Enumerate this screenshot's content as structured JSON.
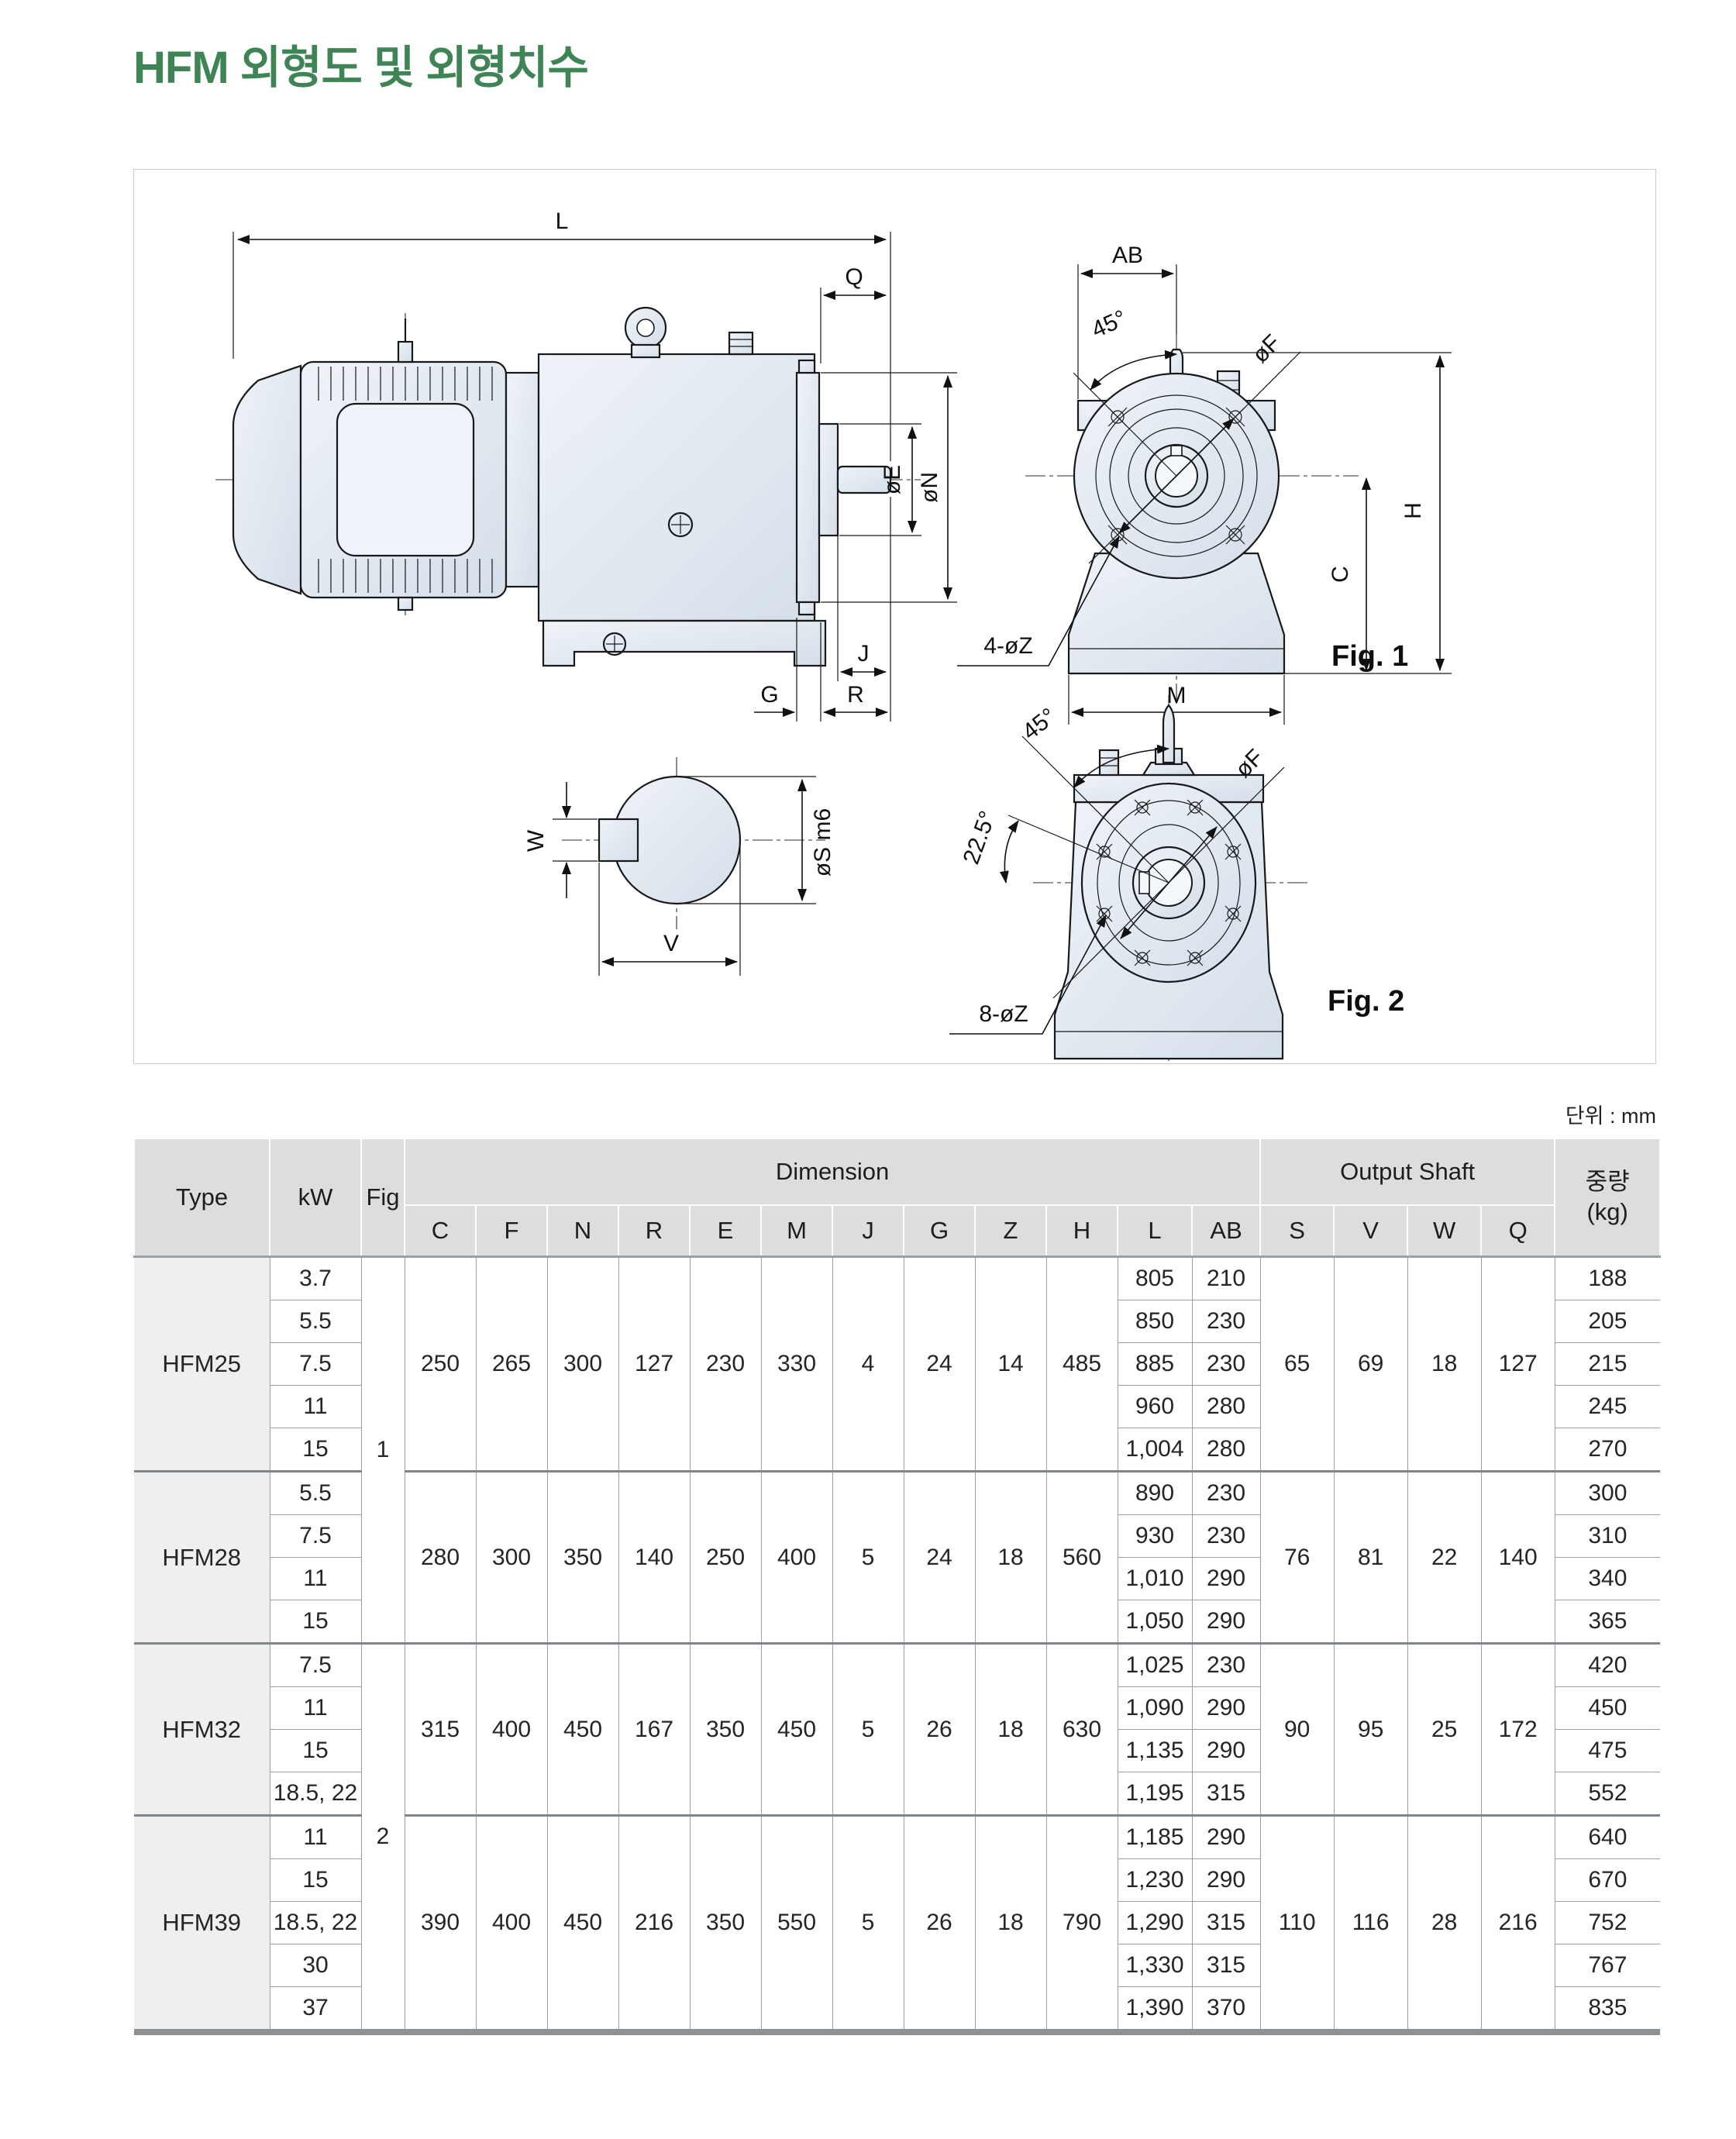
{
  "page": {
    "title": "HFM 외형도 및 외형치수",
    "unit_note": "단위 : mm"
  },
  "drawing": {
    "side_view": {
      "L": "L",
      "Q": "Q",
      "oE": "øE",
      "oN": "øN",
      "J": "J",
      "G": "G",
      "R": "R"
    },
    "fig1": {
      "AB": "AB",
      "angle45": "45°",
      "oF": "øF",
      "H": "H",
      "C": "C",
      "M": "M",
      "bolts": "4-øZ",
      "caption": "Fig. 1"
    },
    "shaft_section": {
      "W": "W",
      "V": "V",
      "oS": "øS m6"
    },
    "fig2": {
      "angle45": "45°",
      "angle225": "22.5°",
      "oF": "øF",
      "bolts": "8-øZ",
      "caption": "Fig. 2"
    }
  },
  "table": {
    "header": {
      "type": "Type",
      "kw": "kW",
      "fig": "Fig",
      "dimension_group": "Dimension",
      "output_shaft_group": "Output Shaft",
      "weight_line1": "중량",
      "weight_line2": "(kg)",
      "dim_cols": [
        "C",
        "F",
        "N",
        "R",
        "E",
        "M",
        "J",
        "G",
        "Z",
        "H",
        "L",
        "AB"
      ],
      "shaft_cols": [
        "S",
        "V",
        "W",
        "Q"
      ]
    },
    "groups": [
      {
        "type": "HFM25",
        "fig": "1",
        "dims": {
          "C": "250",
          "F": "265",
          "N": "300",
          "R": "127",
          "E": "230",
          "M": "330",
          "J": "4",
          "G": "24",
          "Z": "14",
          "H": "485"
        },
        "shaft": {
          "S": "65",
          "V": "69",
          "W": "18",
          "Q": "127"
        },
        "rows": [
          {
            "kw": "3.7",
            "L": "805",
            "AB": "210",
            "weight": "188"
          },
          {
            "kw": "5.5",
            "L": "850",
            "AB": "230",
            "weight": "205"
          },
          {
            "kw": "7.5",
            "L": "885",
            "AB": "230",
            "weight": "215"
          },
          {
            "kw": "11",
            "L": "960",
            "AB": "280",
            "weight": "245"
          },
          {
            "kw": "15",
            "L": "1,004",
            "AB": "280",
            "weight": "270"
          }
        ]
      },
      {
        "type": "HFM28",
        "dims": {
          "C": "280",
          "F": "300",
          "N": "350",
          "R": "140",
          "E": "250",
          "M": "400",
          "J": "5",
          "G": "24",
          "Z": "18",
          "H": "560"
        },
        "shaft": {
          "S": "76",
          "V": "81",
          "W": "22",
          "Q": "140"
        },
        "rows": [
          {
            "kw": "5.5",
            "L": "890",
            "AB": "230",
            "weight": "300"
          },
          {
            "kw": "7.5",
            "L": "930",
            "AB": "230",
            "weight": "310"
          },
          {
            "kw": "11",
            "L": "1,010",
            "AB": "290",
            "weight": "340"
          },
          {
            "kw": "15",
            "L": "1,050",
            "AB": "290",
            "weight": "365"
          }
        ]
      },
      {
        "type": "HFM32",
        "fig": "2",
        "dims": {
          "C": "315",
          "F": "400",
          "N": "450",
          "R": "167",
          "E": "350",
          "M": "450",
          "J": "5",
          "G": "26",
          "Z": "18",
          "H": "630"
        },
        "shaft": {
          "S": "90",
          "V": "95",
          "W": "25",
          "Q": "172"
        },
        "rows": [
          {
            "kw": "7.5",
            "L": "1,025",
            "AB": "230",
            "weight": "420"
          },
          {
            "kw": "11",
            "L": "1,090",
            "AB": "290",
            "weight": "450"
          },
          {
            "kw": "15",
            "L": "1,135",
            "AB": "290",
            "weight": "475"
          },
          {
            "kw": "18.5, 22",
            "L": "1,195",
            "AB": "315",
            "weight": "552"
          }
        ]
      },
      {
        "type": "HFM39",
        "dims": {
          "C": "390",
          "F": "400",
          "N": "450",
          "R": "216",
          "E": "350",
          "M": "550",
          "J": "5",
          "G": "26",
          "Z": "18",
          "H": "790"
        },
        "shaft": {
          "S": "110",
          "V": "116",
          "W": "28",
          "Q": "216"
        },
        "rows": [
          {
            "kw": "11",
            "L": "1,185",
            "AB": "290",
            "weight": "640"
          },
          {
            "kw": "15",
            "L": "1,230",
            "AB": "290",
            "weight": "670"
          },
          {
            "kw": "18.5, 22",
            "L": "1,290",
            "AB": "315",
            "weight": "752"
          },
          {
            "kw": "30",
            "L": "1,330",
            "AB": "315",
            "weight": "767"
          },
          {
            "kw": "37",
            "L": "1,390",
            "AB": "370",
            "weight": "835"
          }
        ]
      }
    ]
  }
}
